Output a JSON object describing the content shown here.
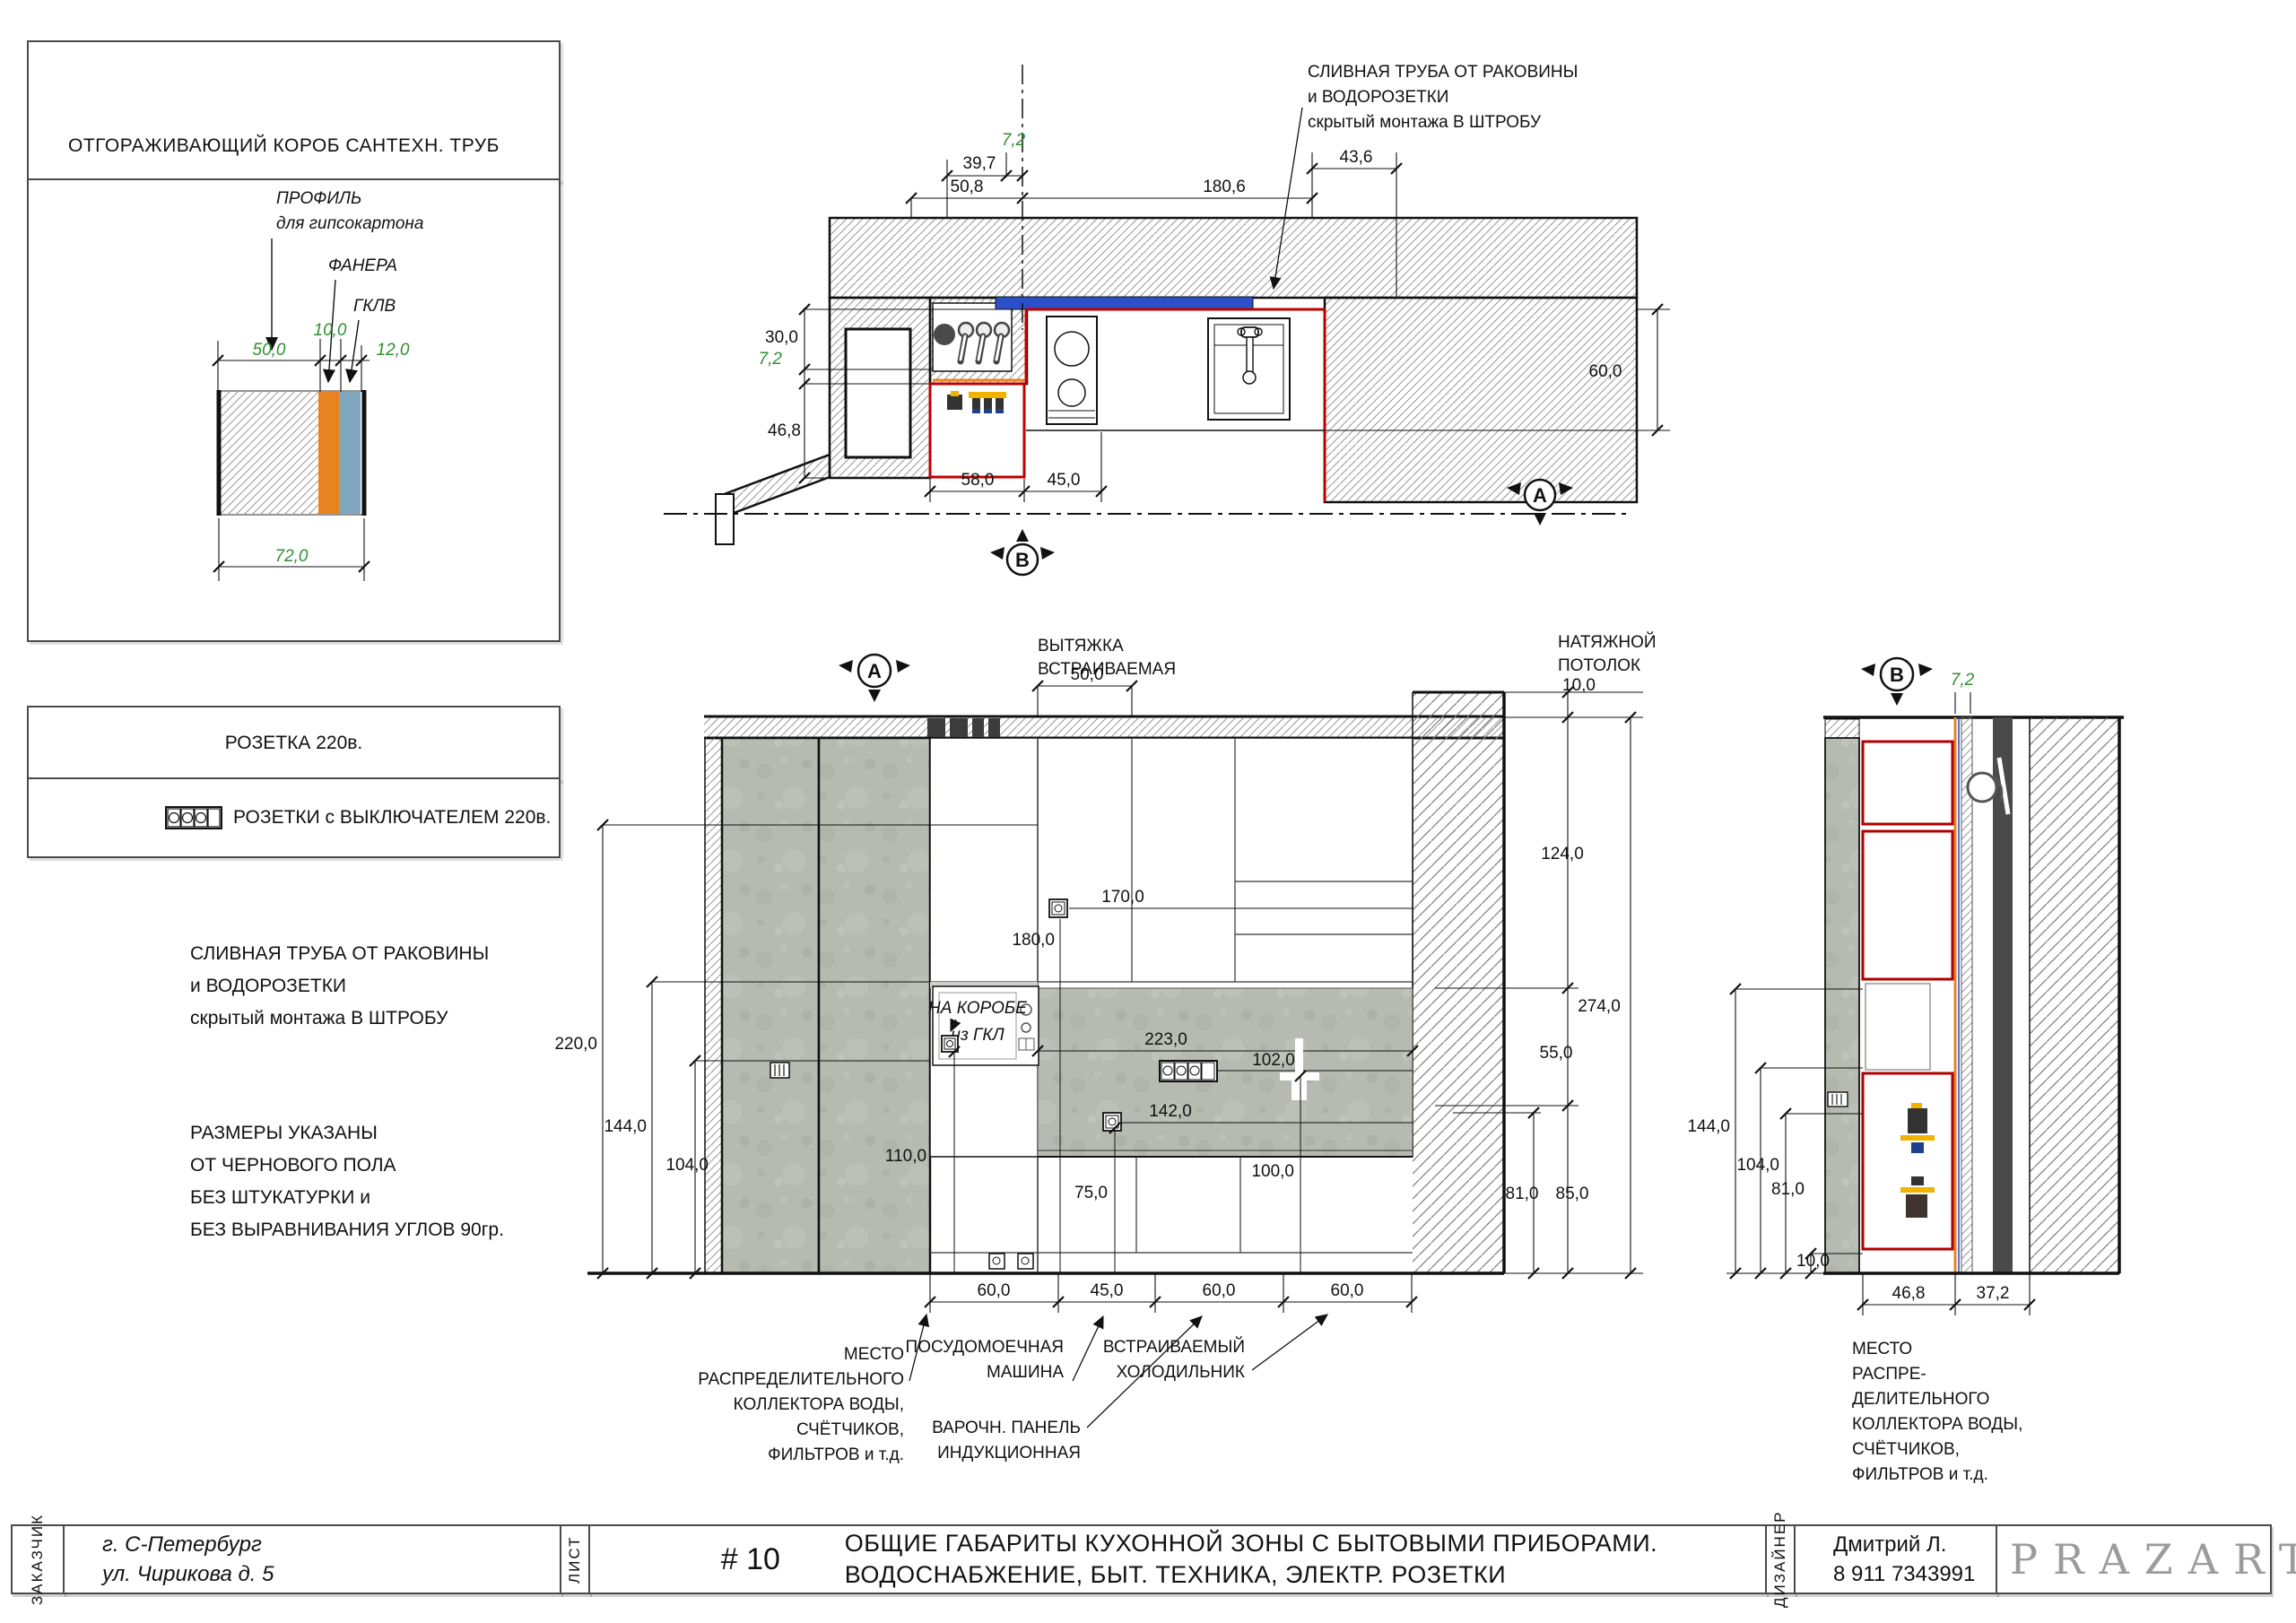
{
  "left_panel": {
    "box_title": "ОТГОРАЖИВАЮЩИЙ КОРОБ САНТЕХН. ТРУБ",
    "detail": {
      "profile_l1": "ПРОФИЛЬ",
      "profile_l2": "для гипсокартона",
      "plywood": "ФАНЕРА",
      "gkl": "ГКЛВ",
      "d50": "50,0",
      "d10": "10,0",
      "d12": "12,0",
      "d72": "72,0"
    },
    "legend_socket": "РОЗЕТКА 220в.",
    "legend_socket_switch": "РОЗЕТКИ с ВЫКЛЮЧАТЕЛЕМ 220в.",
    "drain_note": [
      "СЛИВНАЯ ТРУБА ОТ РАКОВИНЫ",
      "и ВОДОРОЗЕТКИ",
      "скрытый монтажа В ШТРОБУ"
    ],
    "sizes_note": [
      "РАЗМЕРЫ УКАЗАНЫ",
      "ОТ ЧЕРНОВОГО ПОЛА",
      "БЕЗ ШТУКАТУРКИ и",
      "БЕЗ ВЫРАВНИВАНИЯ УГЛОВ 90гр."
    ]
  },
  "plan": {
    "drain_note": [
      "СЛИВНАЯ ТРУБА ОТ РАКОВИНЫ",
      "и ВОДОРОЗЕТКИ",
      "скрытый монтажа В ШТРОБУ"
    ],
    "marker_a": "A",
    "marker_b": "B",
    "dims": {
      "t7_2": "7,2",
      "t39_7": "39,7",
      "t50_8": "50,8",
      "t180_6": "180,6",
      "t43_6": "43,6",
      "l30": "30,0",
      "l7_2": "7,2",
      "l46_8": "46,8",
      "b58": "58,0",
      "b45": "45,0",
      "r60": "60,0"
    }
  },
  "elev_a": {
    "marker": "A",
    "hood": [
      "ВЫТЯЖКА",
      "ВСТРАИВАЕМАЯ"
    ],
    "ceiling": [
      "НАТЯЖНОЙ",
      "ПОТОЛОК"
    ],
    "korobe": [
      "НА КОРОБЕ",
      "из ГКЛ"
    ],
    "dims": {
      "hood50": "50,0",
      "c10": "10,0",
      "r124": "124,0",
      "r274": "274,0",
      "r55": "55,0",
      "r85": "85,0",
      "r81": "81,0",
      "l220": "220,0",
      "l144": "144,0",
      "l104": "104,0",
      "m170": "170,0",
      "m180": "180,0",
      "m223": "223,0",
      "m102": "102,0",
      "m142": "142,0",
      "m110": "110,0",
      "m75": "75,0",
      "m100": "100,0",
      "b60a": "60,0",
      "b45": "45,0",
      "b60b": "60,0",
      "b60c": "60,0"
    },
    "ann_collector": [
      "МЕСТО",
      "РАСПРЕДЕЛИТЕЛЬНОГО",
      "КОЛЛЕКТОРА ВОДЫ,",
      "СЧЁТЧИКОВ,",
      "ФИЛЬТРОВ и т.д."
    ],
    "ann_dishwasher": [
      "ПОСУДОМОЕЧНАЯ",
      "МАШИНА"
    ],
    "ann_hob": [
      "ВАРОЧН. ПАНЕЛЬ",
      "ИНДУКЦИОННАЯ"
    ],
    "ann_fridge": [
      "ВСТРАИВАЕМЫЙ",
      "ХОЛОДИЛЬНИК"
    ]
  },
  "elev_b": {
    "marker": "B",
    "dims": {
      "g7_2": "7,2",
      "l144": "144,0",
      "l104": "104,0",
      "l81": "81,0",
      "l10": "10,0",
      "b46_8": "46,8",
      "b37_2": "37,2"
    },
    "ann_collector": [
      "МЕСТО",
      "РАСПРЕ-",
      "ДЕЛИТЕЛЬНОГО",
      "КОЛЛЕКТОРА ВОДЫ,",
      "СЧЁТЧИКОВ,",
      "ФИЛЬТРОВ и т.д."
    ]
  },
  "title_block": {
    "customer_label": "ЗАКАЗЧИК",
    "customer": [
      "г. С-Петербург",
      "ул. Чирикова д. 5"
    ],
    "sheet_label": "ЛИСТ",
    "sheet_no": "# 10",
    "title": [
      "ОБЩИЕ ГАБАРИТЫ КУХОННОЙ ЗОНЫ С БЫТОВЫМИ ПРИБОРАМИ.",
      "ВОДОСНАБЖЕНИЕ, БЫТ. ТЕХНИКА, ЭЛЕКТР. РОЗЕТКИ"
    ],
    "designer_label": "ДИЗАЙНЕР",
    "designer": [
      "Дмитрий Л.",
      "8 911 7343991"
    ],
    "logo": "PRAZART"
  },
  "colors": {
    "dim_green": "#2f8f2f",
    "outline_red": "#c00000",
    "pipe_blue": "#2b50c8",
    "plywood_orange": "#e8831f",
    "gkl_blue": "#7fa8bf",
    "shaft_dark": "#4a4a4a",
    "concrete": "#b7bab1",
    "logo_grey": "#9b9b9b"
  }
}
